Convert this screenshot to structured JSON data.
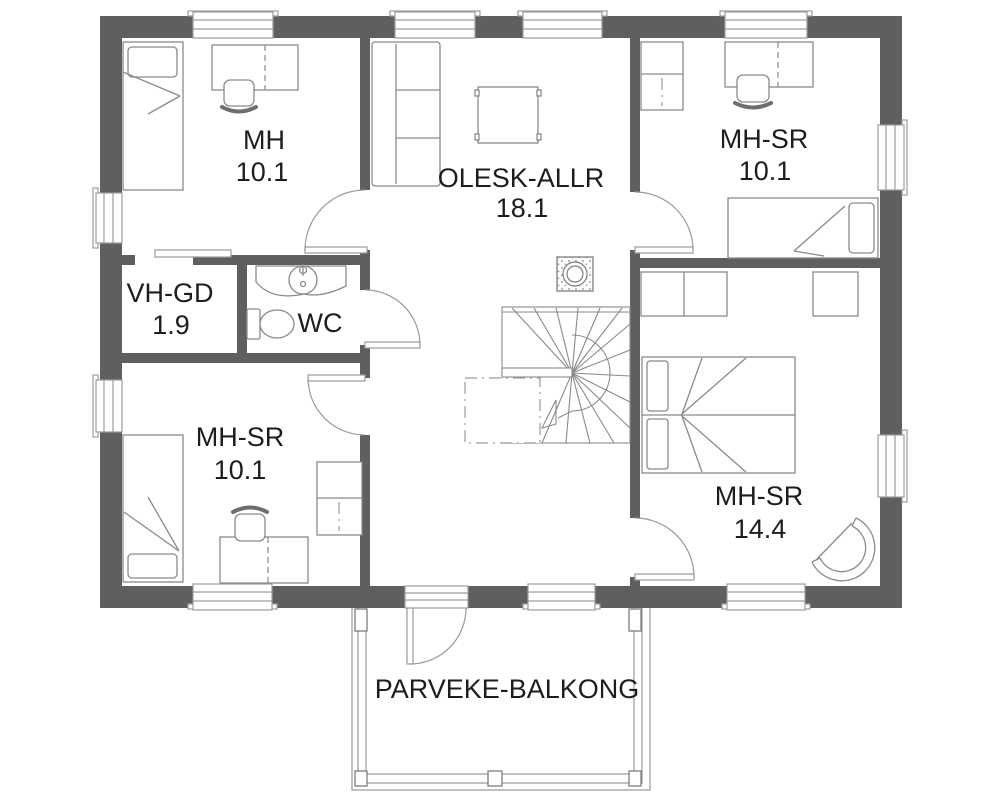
{
  "plan": {
    "title": "upper-floor-plan",
    "rooms": {
      "mh": {
        "name": "MH",
        "area": "10.1"
      },
      "olesk": {
        "name": "OLESK-ALLR",
        "area": "18.1"
      },
      "mh_sr_ne": {
        "name": "MH-SR",
        "area": "10.1"
      },
      "vh_gd": {
        "name": "VH-GD",
        "area": "1.9"
      },
      "wc": {
        "name": "WC"
      },
      "mh_sr_sw": {
        "name": "MH-SR",
        "area": "10.1"
      },
      "mh_sr_se": {
        "name": "MH-SR",
        "area": "14.4"
      },
      "balcony": {
        "name": "PARVEKE-BALKONG"
      }
    },
    "colors": {
      "wall": "#5e5f61",
      "line": "#8a8a8a",
      "text": "#1d1d1d",
      "background": "#ffffff"
    }
  }
}
